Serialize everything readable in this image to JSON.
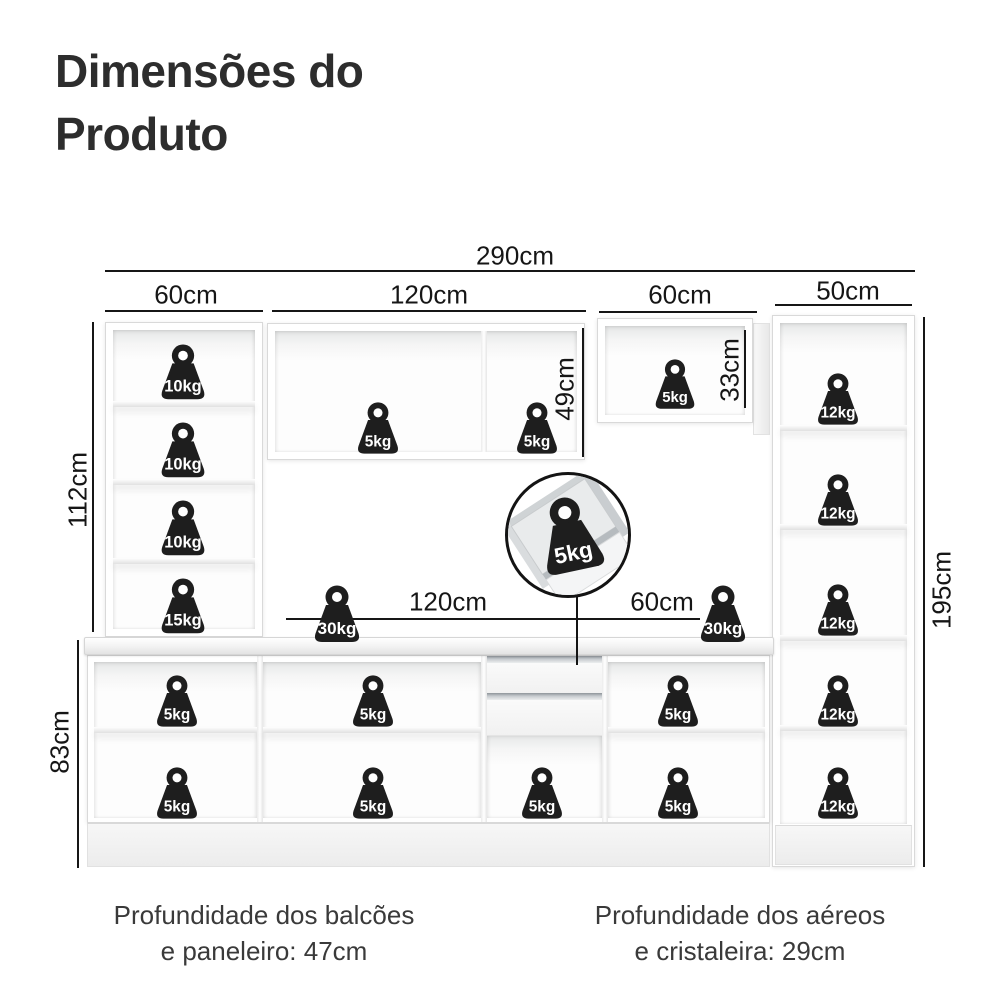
{
  "title": {
    "line1": "Dimensões do",
    "line2": "Produto"
  },
  "dimensions": {
    "total_width": "290cm",
    "paneleiro_width": "60cm",
    "aereo_width": "120cm",
    "aereo2_width": "60cm",
    "cristaleira_width": "50cm",
    "paneleiro_height": "112cm",
    "aereo_height": "49cm",
    "aereo2_height": "33cm",
    "total_height": "195cm",
    "balcao_height": "83cm",
    "counter_width_left": "120cm",
    "counter_width_right": "60cm"
  },
  "weights": [
    {
      "label": "10kg",
      "x": 183,
      "y": 374,
      "size": 62,
      "location": "paneleiro-shelf-1"
    },
    {
      "label": "10kg",
      "x": 183,
      "y": 452,
      "size": 62,
      "location": "paneleiro-shelf-2"
    },
    {
      "label": "10kg",
      "x": 183,
      "y": 530,
      "size": 62,
      "location": "paneleiro-shelf-3"
    },
    {
      "label": "15kg",
      "x": 183,
      "y": 608,
      "size": 62,
      "location": "paneleiro-shelf-4"
    },
    {
      "label": "5kg",
      "x": 378,
      "y": 430,
      "size": 58,
      "location": "aereo-120-left"
    },
    {
      "label": "5kg",
      "x": 537,
      "y": 430,
      "size": 58,
      "location": "aereo-120-right"
    },
    {
      "label": "5kg",
      "x": 675,
      "y": 386,
      "size": 56,
      "location": "aereo-60"
    },
    {
      "label": "12kg",
      "x": 838,
      "y": 401,
      "size": 58,
      "location": "cristaleira-shelf-1"
    },
    {
      "label": "12kg",
      "x": 838,
      "y": 502,
      "size": 58,
      "location": "cristaleira-shelf-2"
    },
    {
      "label": "12kg",
      "x": 838,
      "y": 612,
      "size": 58,
      "location": "cristaleira-shelf-3"
    },
    {
      "label": "12kg",
      "x": 838,
      "y": 703,
      "size": 58,
      "location": "cristaleira-shelf-4"
    },
    {
      "label": "12kg",
      "x": 838,
      "y": 795,
      "size": 58,
      "location": "cristaleira-shelf-5"
    },
    {
      "label": "30kg",
      "x": 337,
      "y": 616,
      "size": 64,
      "location": "countertop-left"
    },
    {
      "label": "30kg",
      "x": 723,
      "y": 616,
      "size": 64,
      "location": "countertop-right"
    },
    {
      "label": "5kg",
      "x": 177,
      "y": 703,
      "size": 58,
      "location": "balcao-1-top"
    },
    {
      "label": "5kg",
      "x": 177,
      "y": 795,
      "size": 58,
      "location": "balcao-1-bottom"
    },
    {
      "label": "5kg",
      "x": 373,
      "y": 703,
      "size": 58,
      "location": "balcao-2-top"
    },
    {
      "label": "5kg",
      "x": 373,
      "y": 795,
      "size": 58,
      "location": "balcao-2-bottom"
    },
    {
      "label": "5kg",
      "x": 542,
      "y": 795,
      "size": 58,
      "location": "under-drawers"
    },
    {
      "label": "5kg",
      "x": 678,
      "y": 703,
      "size": 58,
      "location": "balcao-3-top"
    },
    {
      "label": "5kg",
      "x": 678,
      "y": 795,
      "size": 58,
      "location": "balcao-3-bottom"
    }
  ],
  "inset": {
    "label": "5kg"
  },
  "captions": {
    "left_line1": "Profundidade dos balcões",
    "left_line2": "e paneleiro: 47cm",
    "right_line1": "Profundidade dos aéreos",
    "right_line2": "e cristaleira: 29cm"
  },
  "colors": {
    "weight": "#1e1e1e",
    "line": "#161616",
    "title": "#2d2d2d"
  }
}
